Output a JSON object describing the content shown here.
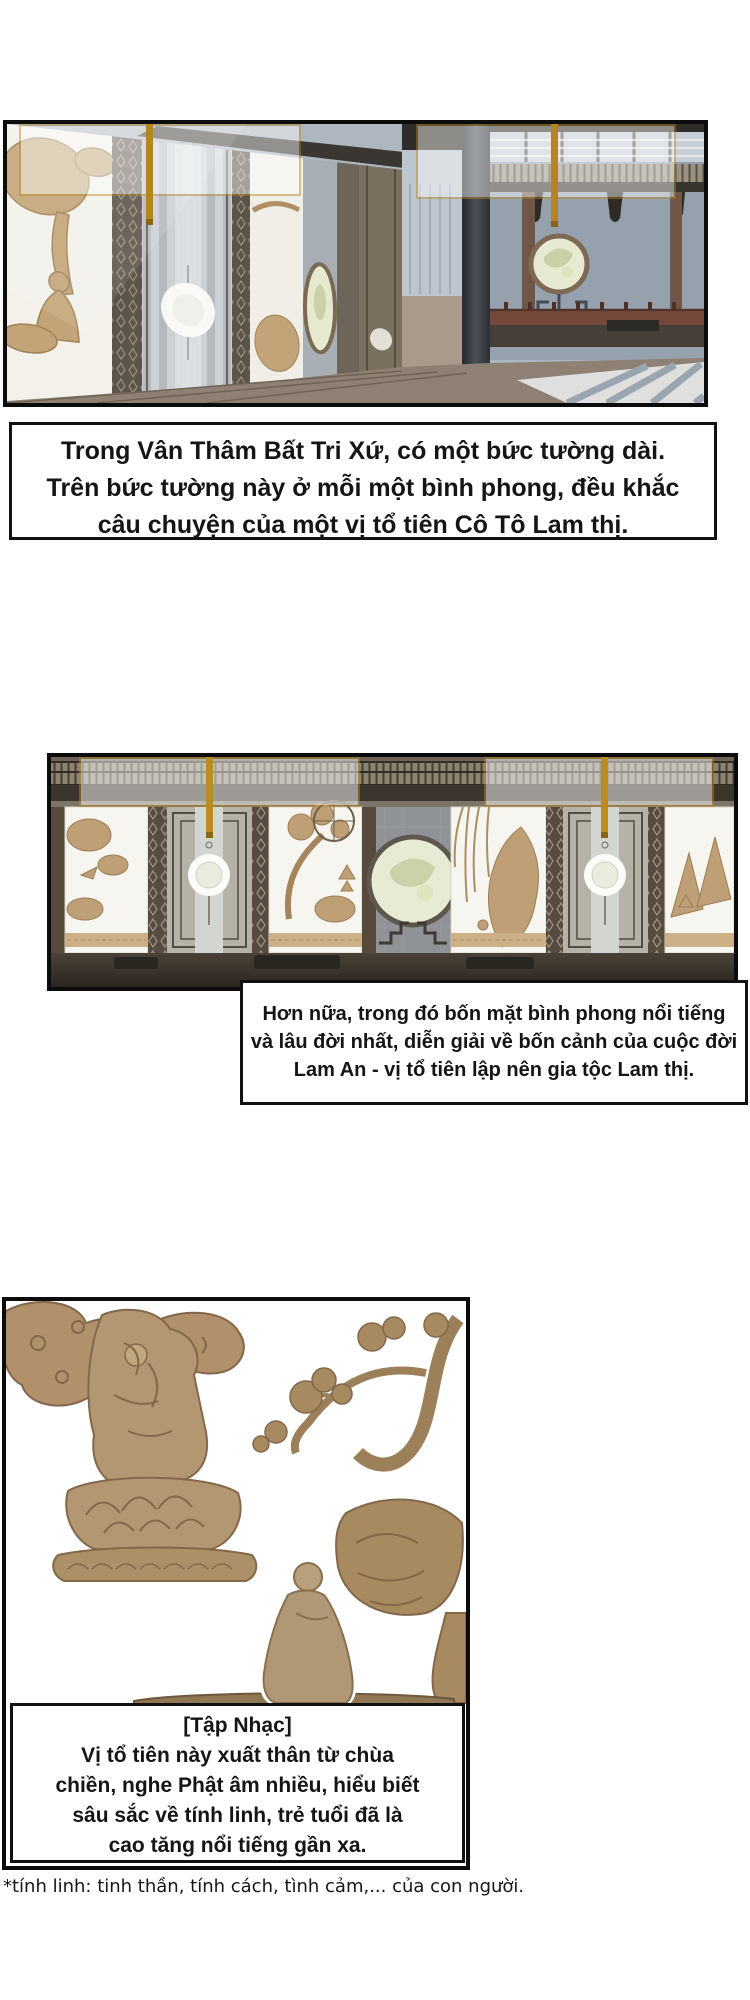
{
  "narration1": {
    "lines": [
      "Trong Vân Thâm Bất Tri Xứ, có một bức tường dài.",
      "Trên bức tường này ở mỗi một bình phong, đều khắc",
      "câu chuyện của một vị tổ tiên Cô Tô Lam thị."
    ]
  },
  "narration2": {
    "lines": [
      "Hơn nữa, trong đó bốn mặt bình phong nổi tiếng",
      "và lâu đời nhất, diễn giải về bốn cảnh của cuộc đời",
      "Lam An - vị tổ tiên lập nên gia tộc Lam thị."
    ]
  },
  "narration3": {
    "heading": "[Tập Nhạc]",
    "lines": [
      "Vị tổ tiên này xuất thân từ chùa",
      "chiền, nghe Phật âm nhiều, hiểu biết",
      "sâu sắc về tính linh, trẻ tuổi đã là",
      "cao tăng nổi tiếng gần xa."
    ]
  },
  "footnote": {
    "text": "*tính linh: tinh thần, tính cách, tình cảm,... của con người."
  },
  "colors": {
    "panel_border": "#0c0c0c",
    "text": "#151515",
    "gold_accent": "#b5861f",
    "carving_tan": "#bfa076",
    "screen_white": "#f6f4ee",
    "wall_blue_gray": "#96a1ae",
    "wood_dark": "#3b352d",
    "moon_glass": "#e8ebd3",
    "relief_tan": "#b09377"
  }
}
